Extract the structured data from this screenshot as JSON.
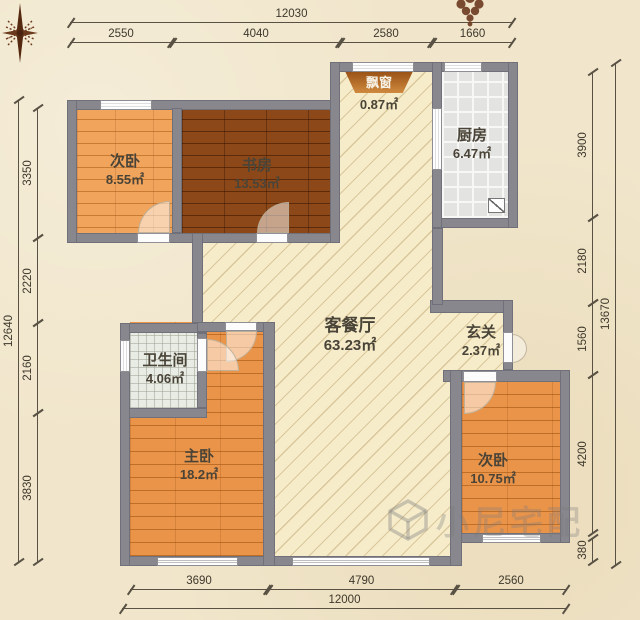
{
  "rooms": [
    {
      "id": "bedroom-top-left",
      "name": "次卧",
      "area": "8.55㎡"
    },
    {
      "id": "study",
      "name": "书房",
      "area": "13.53㎡"
    },
    {
      "id": "bay-window",
      "name": "飘窗",
      "area": "0.87㎡"
    },
    {
      "id": "kitchen",
      "name": "厨房",
      "area": "6.47㎡"
    },
    {
      "id": "living-dining",
      "name": "客餐厅",
      "area": "63.23㎡"
    },
    {
      "id": "entry",
      "name": "玄关",
      "area": "2.37㎡"
    },
    {
      "id": "bathroom",
      "name": "卫生间",
      "area": "4.06㎡"
    },
    {
      "id": "master-bedroom",
      "name": "主卧",
      "area": "18.2㎡"
    },
    {
      "id": "bedroom-bottom-right",
      "name": "次卧",
      "area": "10.75㎡"
    }
  ],
  "dims": {
    "top": {
      "overall": "12030",
      "segments": [
        "2550",
        "4040",
        "2580",
        "1660"
      ]
    },
    "bottom": {
      "overall": "12000",
      "segments": [
        "3690",
        "4790",
        "2560"
      ]
    },
    "left": {
      "overall": "12640",
      "segments": [
        "3350",
        "2220",
        "2160",
        "3830"
      ]
    },
    "right": {
      "overall": "13670",
      "segments": [
        "3900",
        "2180",
        "1560",
        "4200",
        "380"
      ]
    }
  },
  "watermark": {
    "text": "小尼宅配"
  },
  "icons": [
    "compass-rose-icon",
    "floral-ornament-icon",
    "cube-logo-icon",
    "appliance-icon"
  ],
  "colors": {
    "wall": "#87878d",
    "hatch_floor": "#f6ecca",
    "wood_light": "#e9964f",
    "wood_dark": "#7f3e10",
    "wood_medium": "#e0853d",
    "kitchen_tile": "#e3e3e1",
    "bath_tile": "#e9ece4",
    "background": "#f1e6cb",
    "bay_window": "#b06a28"
  }
}
